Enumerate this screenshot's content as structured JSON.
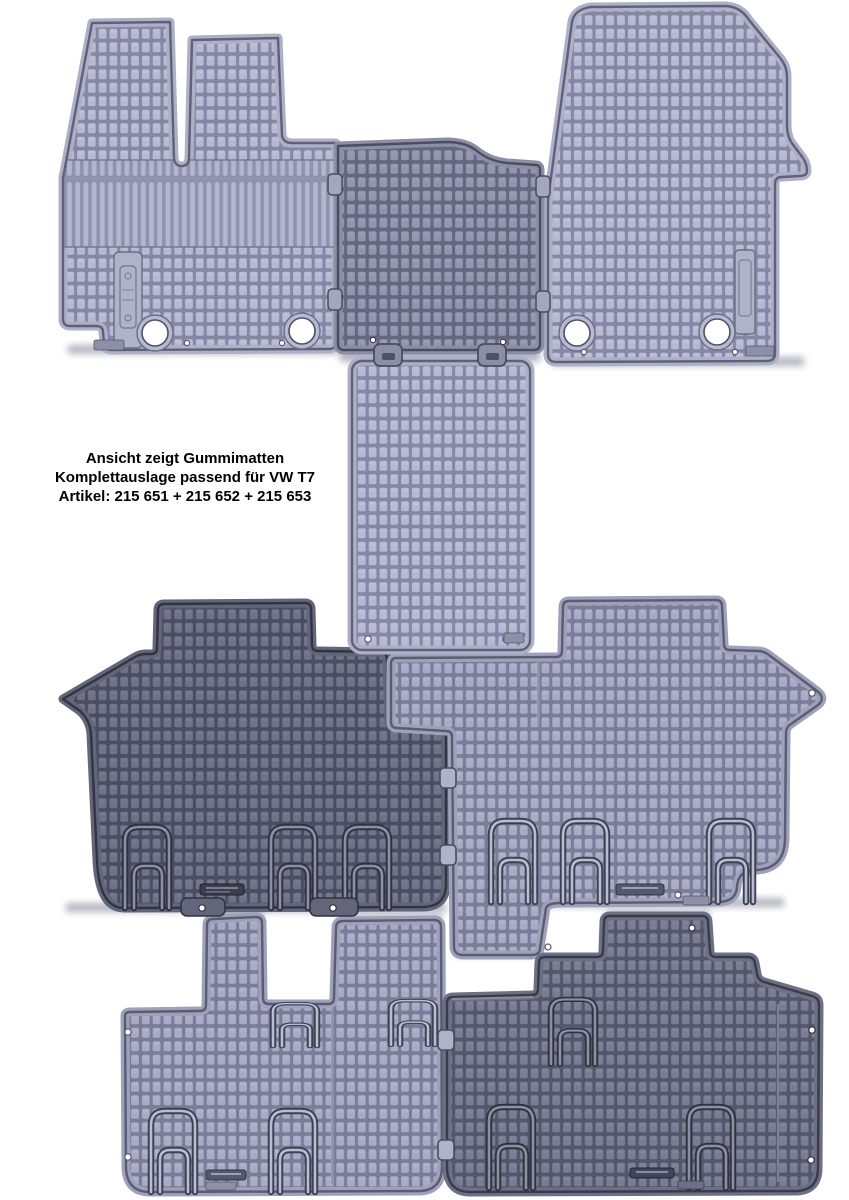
{
  "page": {
    "background": "#ffffff"
  },
  "caption": {
    "line1": "Ansicht zeigt Gummimatten",
    "line2": "Komplettauslage passend für VW T7",
    "line3": "Artikel: 215 651 + 215 652 + 215 653"
  },
  "product": {
    "shown": "Gummimatten Komplettauslage",
    "vehicle": "VW T7",
    "articles": [
      "215 651",
      "215 652",
      "215 653"
    ]
  },
  "mats": [
    {
      "id": "front-driver-mat",
      "tone": "light"
    },
    {
      "id": "front-center-mat",
      "tone": "medium-dark"
    },
    {
      "id": "front-passenger-mat",
      "tone": "light"
    },
    {
      "id": "center-aisle-runner",
      "tone": "light"
    },
    {
      "id": "second-row-left-mat",
      "tone": "dark"
    },
    {
      "id": "second-row-right-mat",
      "tone": "medium-light"
    },
    {
      "id": "third-row-left-mat",
      "tone": "medium-light"
    },
    {
      "id": "third-row-right-mat",
      "tone": "medium-dark"
    }
  ],
  "colors": {
    "mat_light": "#b7b9d2",
    "mat_medium_light": "#a9abc6",
    "mat_medium_dark": "#9395ae",
    "mat_dark": "#707288",
    "mat_dark2": "#7a7c93",
    "caption_text": "#000000"
  }
}
